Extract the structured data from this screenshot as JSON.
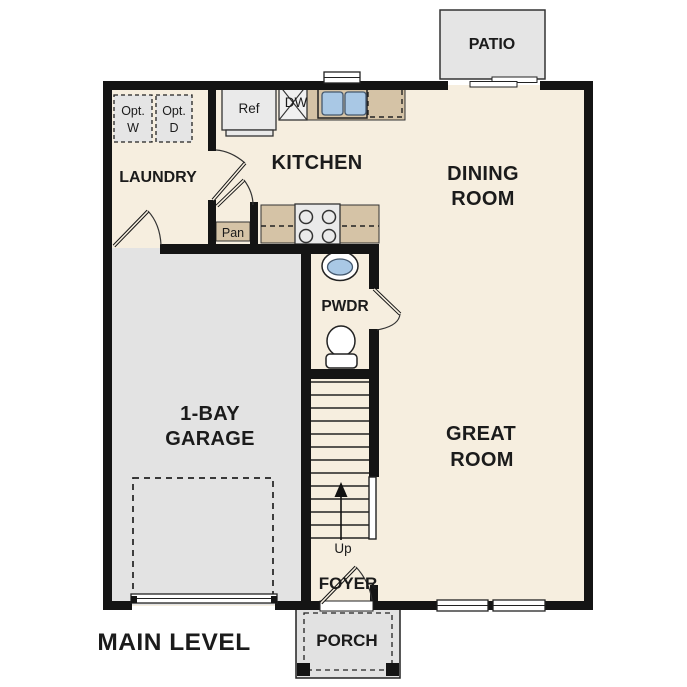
{
  "plan_title": "MAIN LEVEL",
  "rooms": {
    "patio": "PATIO",
    "laundry": "LAUNDRY",
    "kitchen": "KITCHEN",
    "dining_line1": "DINING",
    "dining_line2": "ROOM",
    "powder": "PWDR",
    "garage_line1": "1-BAY",
    "garage_line2": "GARAGE",
    "great_line1": "GREAT",
    "great_line2": "ROOM",
    "foyer": "FOYER",
    "porch": "PORCH"
  },
  "fixtures": {
    "refrigerator": "Ref",
    "dishwasher": "DW",
    "pantry": "Pan",
    "stairs_direction": "Up",
    "optional_washer_line1": "Opt.",
    "optional_washer_line2": "W",
    "optional_dryer_line1": "Opt.",
    "optional_dryer_line2": "D"
  },
  "colors": {
    "floor_color": "#f6eedf",
    "garage_color": "#e3e3e3",
    "patio_color": "#e5e5e5",
    "porch_color": "#e2e2e2",
    "counter_color": "#d5c3a6",
    "appliance_color": "#eaeaea",
    "sink_color": "#a9c8e5",
    "wall_color": "#141414",
    "text_color": "#1b1b1b"
  }
}
